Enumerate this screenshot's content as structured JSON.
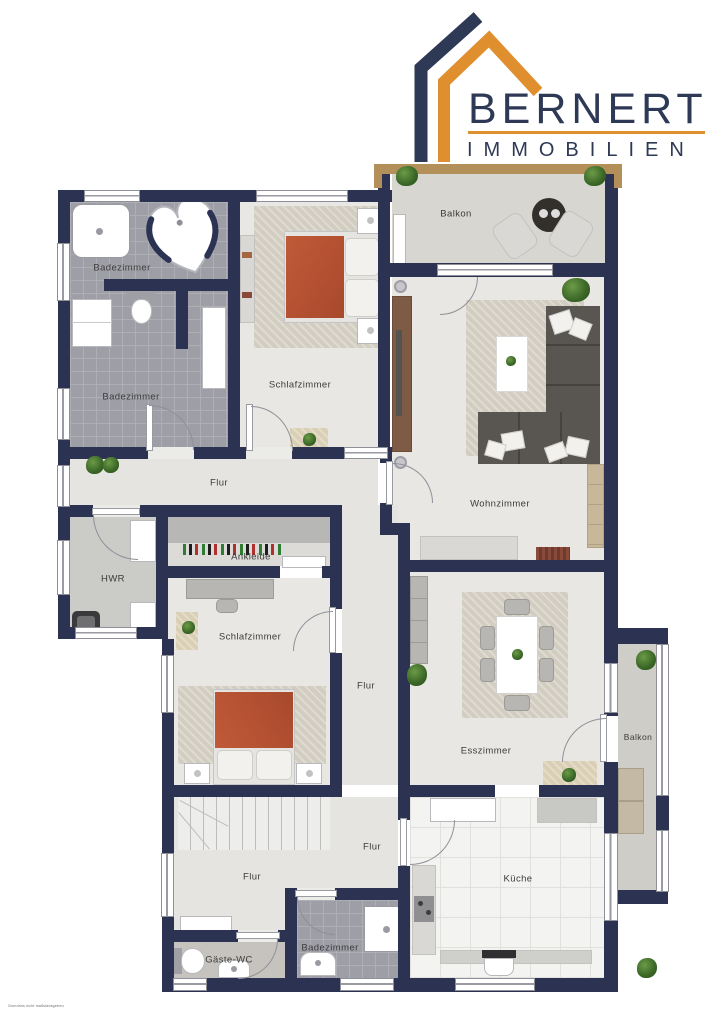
{
  "logo": {
    "brand": "BERNERT",
    "subtitle": "IMMOBILIEN",
    "navy": "#2e3956",
    "orange": "#e08f2f"
  },
  "colors": {
    "wall": "#2c3352",
    "floor_light": "#e8e7e4",
    "floor_tile": "#9e9ea6",
    "accent_bed": "#b65332",
    "railing_wood": "#b3905a"
  },
  "rooms": [
    {
      "key": "badezimmer-top",
      "label": "Badezimmer"
    },
    {
      "key": "badezimmer-left",
      "label": "Badezimmer"
    },
    {
      "key": "schlafzimmer-top",
      "label": "Schlafzimmer"
    },
    {
      "key": "balkon-top",
      "label": "Balkon"
    },
    {
      "key": "wohnzimmer",
      "label": "Wohnzimmer"
    },
    {
      "key": "flur-upper",
      "label": "Flur"
    },
    {
      "key": "hwr",
      "label": "HWR"
    },
    {
      "key": "ankleide",
      "label": "Ankleide"
    },
    {
      "key": "schlafzimmer-mid",
      "label": "Schlafzimmer"
    },
    {
      "key": "flur-mid",
      "label": "Flur"
    },
    {
      "key": "esszimmer",
      "label": "Esszimmer"
    },
    {
      "key": "balkon-right",
      "label": "Balkon"
    },
    {
      "key": "flur-right",
      "label": "Flur"
    },
    {
      "key": "flur-lower",
      "label": "Flur"
    },
    {
      "key": "kueche",
      "label": "Küche"
    },
    {
      "key": "gaeste-wc",
      "label": "Gäste-WC"
    },
    {
      "key": "badezimmer-bottom",
      "label": "Badezimmer"
    }
  ],
  "fine_print": "Grundriss nicht maßstabsgetreu"
}
